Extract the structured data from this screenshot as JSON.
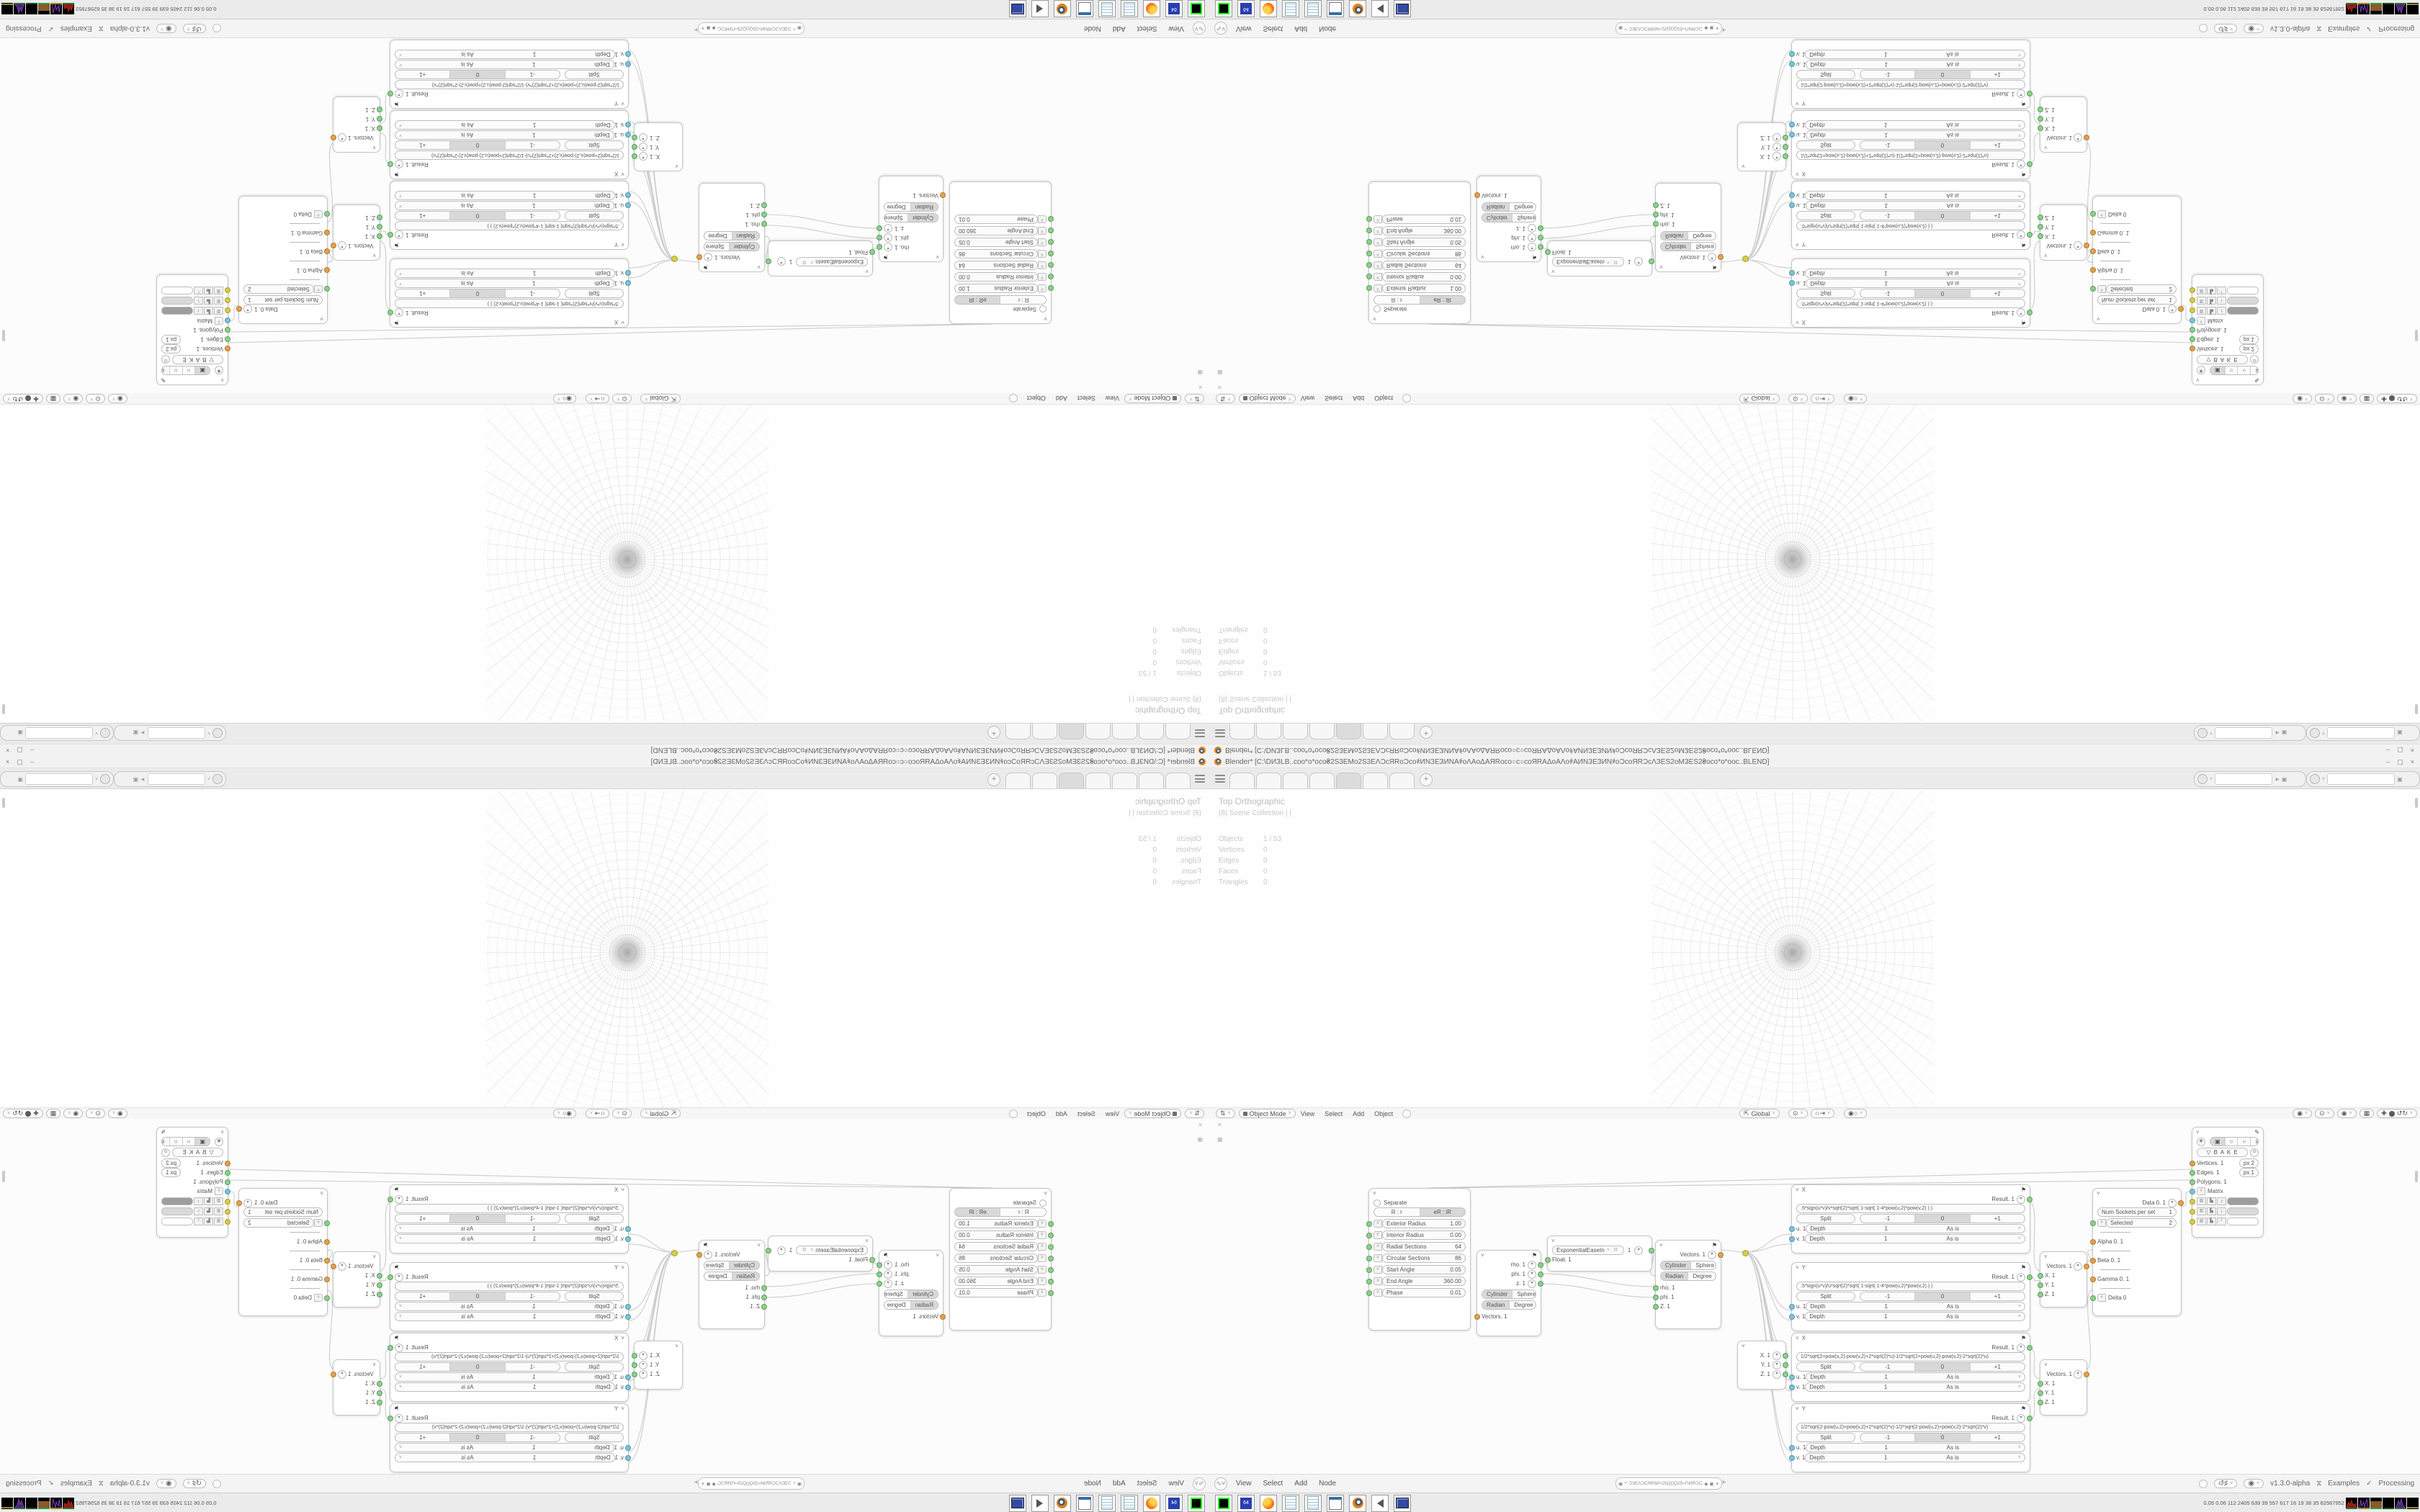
{
  "window": {
    "title": "Blender* [C:\\DИЗLB..coo*o*oco₴2S3EMo2S3EΛƆcЯRoƆco҂ИNЗЕЗИNA҂oΛAoΔAЯRoco○c○coЯRAΔoAΛo҂AИNЗЕЗИN҂oƆcoЯRƆcΛЗЕS2oMЗЕS2₴oco*o*ooc..BLEND]",
    "minimize": "–",
    "maximize": "▢",
    "close": "×"
  },
  "tab_bar": {
    "new_tab_label": "+"
  },
  "viewport": {
    "view_label": "Top Orthographic",
    "collection_label": "(8) Scene Collection | |",
    "stats": [
      [
        "Objects",
        "1 / 53"
      ],
      [
        "Vertices",
        "0"
      ],
      [
        "Edges",
        "0"
      ],
      [
        "Faces",
        "0"
      ],
      [
        "Triangles",
        "0"
      ]
    ]
  },
  "viewport_header": {
    "mode": "Object Mode",
    "menus": [
      "View",
      "Select",
      "Add",
      "Object"
    ],
    "orientation": "Global"
  },
  "node_editor": {
    "menus": [
      "View",
      "Select",
      "Add",
      "Node"
    ],
    "address": "ƆЗЕΛƆСЯRІИ≈25Ϙ()Ϙ25≈ПИЯƆСΛЗЕƆ",
    "status": {
      "version": "v1.3.0-alpha",
      "examples": "Examples",
      "processing": "Processing"
    }
  },
  "taskbar": {
    "perf": "0.05 0.06 112 2405 639 39 557 617 16 19 38 35 62567952"
  },
  "nodes": {
    "separate": {
      "toggle": "Separate",
      "tabs": [
        "R : r",
        "eR : iR"
      ],
      "rows": [
        [
          "Exterior Radius",
          "1.00"
        ],
        [
          "Interior Radius",
          "0.00"
        ],
        [
          "Radial Sections",
          "64"
        ],
        [
          "Circular Sections",
          "86"
        ],
        [
          "Start Angle",
          "0.05"
        ],
        [
          "End Angle",
          "360.00"
        ],
        [
          "Phase",
          "0.01"
        ]
      ]
    },
    "vector_split": {
      "inputs": [
        "rho. 1",
        "phi. 1",
        "z. 1"
      ],
      "toggles": [
        [
          "Cylinder",
          "Sphere"
        ],
        [
          "Radian",
          "Degree"
        ]
      ],
      "output": "Vectors. 1"
    },
    "ease": {
      "selector": "ExponentialEaseIn",
      "value": "1",
      "input": "Float. 1"
    },
    "vector_join": {
      "output": "Vectors. 1",
      "toggles": [
        [
          "Cylinder",
          "Sphere"
        ],
        [
          "Radian",
          "Degree"
        ]
      ],
      "inputs": [
        "rho. 1",
        "phi. 1",
        "Z. 1"
      ]
    },
    "xyz": {
      "rows": [
        "X. 1",
        "Y. 1",
        "Z. 1"
      ]
    },
    "io_labels": {
      "depth": "Depth",
      "depth_value": "1",
      "mode": "As is"
    },
    "formulas": [
      {
        "axis": "X",
        "result": "Result. 1",
        "split": "Split",
        "seg": [
          "-1",
          "0",
          "+1"
        ],
        "formula": ".5*sign(u*v)/v*sqrt(2)*sqrt( 1-sqrt( 1-4*pow(u,2)*pow(v,2) ) )",
        "inputs": [
          {
            "name": "u. 1"
          },
          {
            "name": "v. 1"
          }
        ]
      },
      {
        "axis": "Y",
        "result": "Result. 1",
        "split": "Split",
        "seg": [
          "-1",
          "0",
          "+1"
        ],
        "formula": ".5*sign(u*v)/u*sqrt(2)*sqrt( 1-sqrt( 1-4*pow(u,2)*pow(v,2) ) )",
        "inputs": [
          {
            "name": "u. 1"
          },
          {
            "name": "v. 1"
          }
        ]
      },
      {
        "axis": "X",
        "result": "Result. 1",
        "split": "Split",
        "seg": [
          "-1",
          "0",
          "+1"
        ],
        "formula": "1/2*sqrt(2+pow(u,2)-pow(v,2)+2*sqrt(2)*u)-1/2*sqrt(2+pow(u,2)-pow(v,2)-2*sqrt(2)*u)",
        "inputs": [
          {
            "name": "u. 1"
          },
          {
            "name": "v. 1"
          }
        ]
      },
      {
        "axis": "Y",
        "result": "Result. 1",
        "split": "Split",
        "seg": [
          "-1",
          "0",
          "+1"
        ],
        "formula": "1/2*sqrt(2-pow(u,2)+pow(v,2)+2*sqrt(2)*v)-1/2*sqrt(2-pow(u,2)+pow(v,2)-2*sqrt(2)*v)",
        "inputs": [
          {
            "name": "u. 1"
          },
          {
            "name": "v. 1"
          }
        ]
      }
    ],
    "joins": {
      "output": "Vectors. 1",
      "inputs": [
        "X. 1",
        "Y. 1",
        "Z. 1"
      ]
    },
    "data": {
      "output": "Data 0. 1",
      "num_label": "Num Sockets per set",
      "num_value": "1",
      "selected_label": "Selected",
      "selected_value": "2",
      "sockets": [
        "Alpha 0. 1",
        "Beta 0. 1",
        "Gamma 0. 1",
        "Delta 0"
      ]
    },
    "bake": {
      "bake_label": "▽  B A K E",
      "vertices": "Vertices. 1",
      "vertices_px": "px   2",
      "edges": "Edges. 1",
      "edges_px": "px   1",
      "polygons": "Polygons. 1",
      "matrix": "Matrix"
    }
  }
}
